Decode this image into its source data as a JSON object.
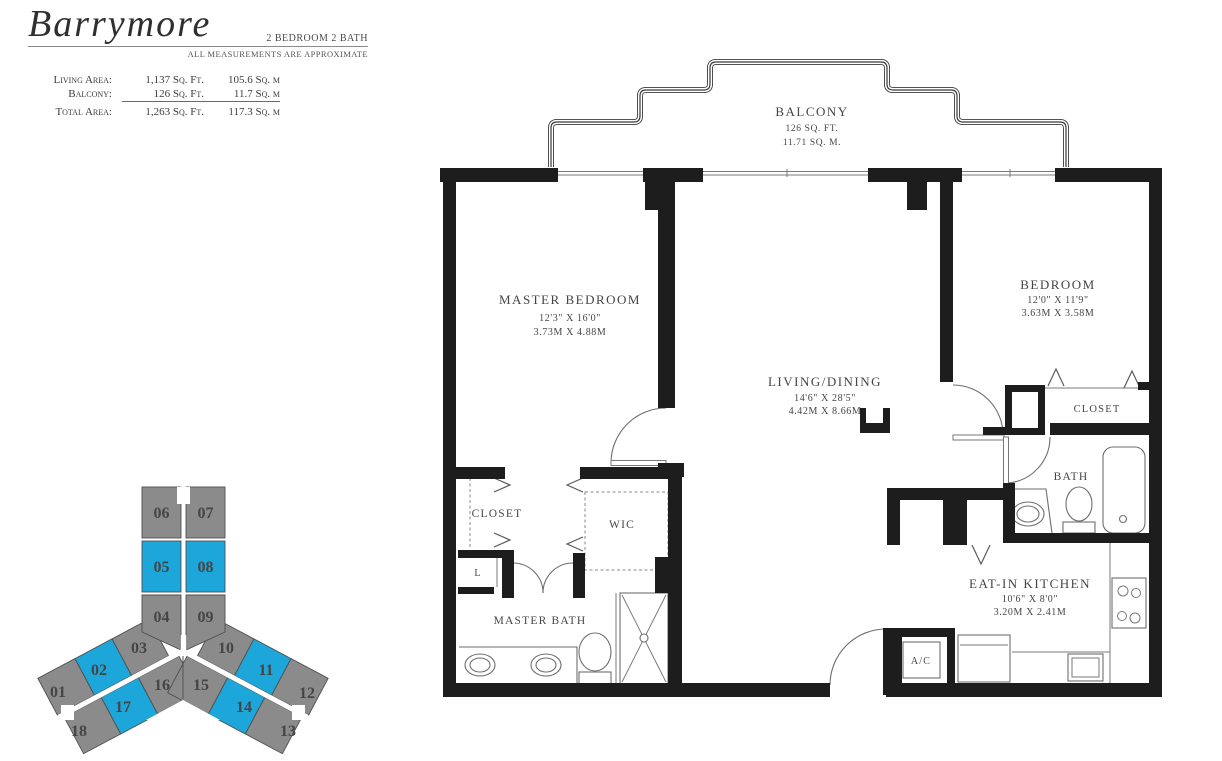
{
  "header": {
    "plan_name": "Barrymore",
    "plan_type": "2 BEDROOM 2 BATH",
    "disclaimer": "ALL MEASUREMENTS ARE APPROXIMATE",
    "stats": [
      {
        "label": "Living Area:",
        "sqft": "1,137 Sq. Ft.",
        "sqm": "105.6 Sq. m"
      },
      {
        "label": "Balcony:",
        "sqft": "126 Sq. Ft.",
        "sqm": "11.7 Sq. m"
      },
      {
        "label": "Total Area:",
        "sqft": "1,263 Sq. Ft.",
        "sqm": "117.3 Sq. m"
      }
    ]
  },
  "keyplan": {
    "unit_color": "#8B8B8B",
    "highlight_color": "#1CA6D9",
    "outline_color": "#4f4f4f",
    "highlighted_units": [
      "02",
      "05",
      "08",
      "11",
      "14",
      "17"
    ],
    "units": [
      {
        "id": "01",
        "highlighted": false
      },
      {
        "id": "02",
        "highlighted": true
      },
      {
        "id": "03",
        "highlighted": false
      },
      {
        "id": "04",
        "highlighted": false
      },
      {
        "id": "05",
        "highlighted": true
      },
      {
        "id": "06",
        "highlighted": false
      },
      {
        "id": "07",
        "highlighted": false
      },
      {
        "id": "08",
        "highlighted": true
      },
      {
        "id": "09",
        "highlighted": false
      },
      {
        "id": "10",
        "highlighted": false
      },
      {
        "id": "11",
        "highlighted": true
      },
      {
        "id": "12",
        "highlighted": false
      },
      {
        "id": "13",
        "highlighted": false
      },
      {
        "id": "14",
        "highlighted": true
      },
      {
        "id": "15",
        "highlighted": false
      },
      {
        "id": "16",
        "highlighted": false
      },
      {
        "id": "17",
        "highlighted": true
      },
      {
        "id": "18",
        "highlighted": false
      }
    ]
  },
  "plan": {
    "balcony": {
      "name": "BALCONY",
      "area_ft": "126 SQ. FT.",
      "area_m": "11.71 SQ. M."
    },
    "master_bedroom": {
      "name": "MASTER BEDROOM",
      "dims_ft": "12'3\" X 16'0\"",
      "dims_m": "3.73M X 4.88M"
    },
    "living_dining": {
      "name": "LIVING/DINING",
      "dims_ft": "14'6\" X 28'5\"",
      "dims_m": "4.42M X 8.66M"
    },
    "bedroom": {
      "name": "BEDROOM",
      "dims_ft": "12'0\" X 11'9\"",
      "dims_m": "3.63M X 3.58M"
    },
    "kitchen": {
      "name": "EAT-IN KITCHEN",
      "dims_ft": "10'6\" X 8'0\"",
      "dims_m": "3.20M X 2.41M"
    },
    "master_bath_label": "MASTER BATH",
    "bath_label": "BATH",
    "wic_label": "WIC",
    "master_closet_label": "CLOSET",
    "bedroom_closet_label": "CLOSET",
    "linen_label": "L",
    "ac_label": "A/C"
  }
}
